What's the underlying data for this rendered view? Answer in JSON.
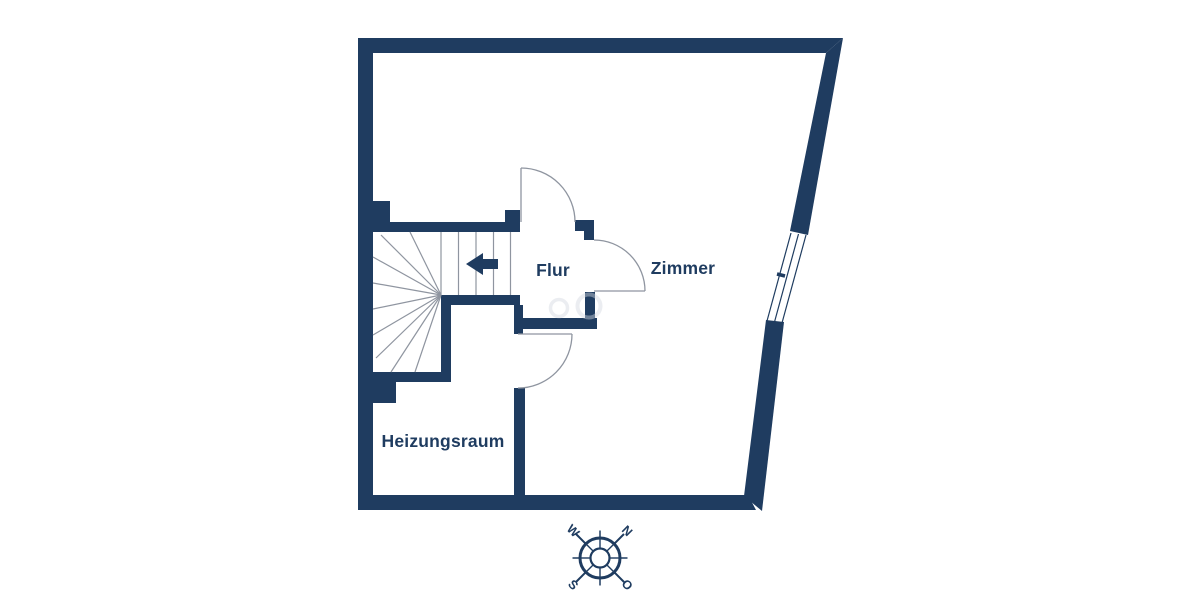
{
  "rooms": {
    "flur": {
      "label": "Flur"
    },
    "zimmer": {
      "label": "Zimmer"
    },
    "heizungsraum": {
      "label": "Heizungsraum"
    }
  },
  "compass": {
    "north": "N",
    "east": "O",
    "south": "S",
    "west": "W"
  },
  "icons": {
    "stair_direction_arrow": "left-arrow",
    "compass": "compass-rose"
  },
  "colors": {
    "wall": "#1f3c60",
    "line": "#8f95a0",
    "label": "#1f3c60",
    "bg": "#ffffff",
    "watermark": "#d3d8df"
  }
}
